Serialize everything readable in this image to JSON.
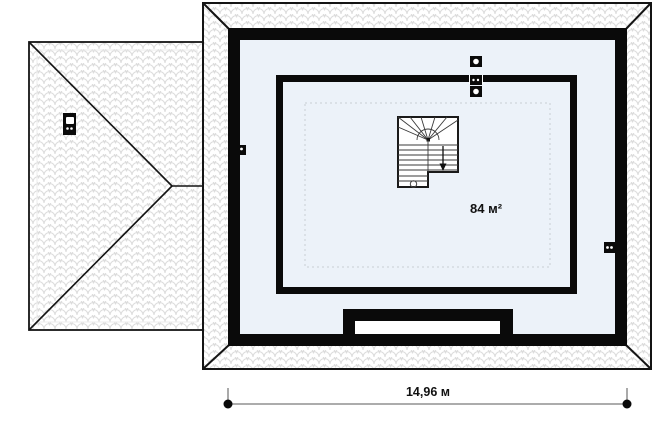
{
  "floor_plan": {
    "area_label": "84 м²",
    "area_value": 84,
    "area_unit": "м²",
    "overall_width_label": "14,96 м",
    "overall_width_value": "14,96",
    "overall_width_unit": "м"
  },
  "icons": {
    "chimney-icon": "black rectangle with white flue square and two white dots",
    "vent-stack-icon": "black square with white circle",
    "stair-down-arrow": "▼",
    "stair-start-circle": "○",
    "dimension-endpoint": "●"
  },
  "colors": {
    "wall_black": "#0a0a0a",
    "floor_blue": "#ecf2f9",
    "roof_line": "#141414",
    "tile_line_gray": "#dcdcdc",
    "dashed_gray": "#c9cdd2",
    "dimension_gray": "#7a7a7a"
  }
}
